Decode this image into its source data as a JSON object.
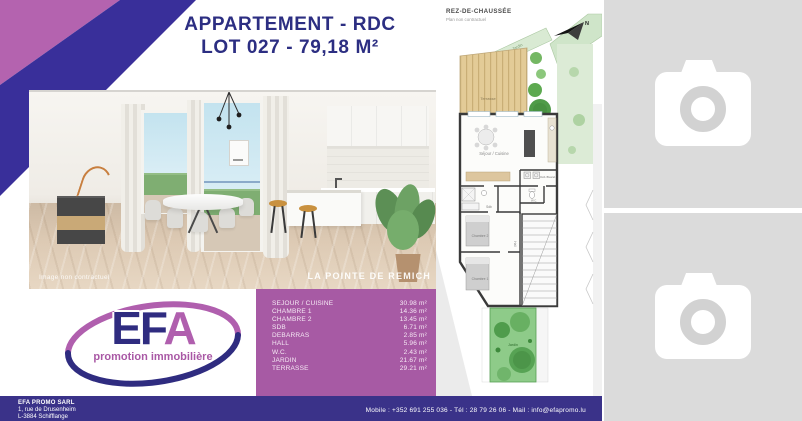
{
  "title": {
    "line1": "APPARTEMENT - RDC",
    "line2": "LOT 027 - 79,18 M²"
  },
  "render": {
    "disclaimer": "Image non contractuel",
    "project": "LA POINTE DE REMICH"
  },
  "areas": {
    "rows": [
      {
        "label": "SEJOUR / CUISINE",
        "value": "30.98 m²"
      },
      {
        "label": "CHAMBRE 1",
        "value": "14.36 m²"
      },
      {
        "label": "CHAMBRE 2",
        "value": "13.45 m²"
      },
      {
        "label": "SDB",
        "value": "6.71 m²"
      },
      {
        "label": "DEBARRAS",
        "value": "2.85 m²"
      },
      {
        "label": "HALL",
        "value": "5.96 m²"
      },
      {
        "label": "W.C.",
        "value": "2.43 m²"
      },
      {
        "label": "JARDIN",
        "value": "21.67 m²"
      },
      {
        "label": "TERRASSE",
        "value": "29.21 m²"
      }
    ]
  },
  "logo": {
    "ef": "EF",
    "a": "A",
    "tagline": "promotion immobilière"
  },
  "plan": {
    "header": "REZ-DE-CHAUSSÉE",
    "subheader": "Plan non contractuel",
    "north": "N",
    "labels": {
      "jardin_top": "Jardin",
      "terrasse": "Terrasse",
      "sejour": "Séjour / Cuisine",
      "deb": "Déb./Buand.",
      "wc": "W.C.",
      "sdb": "Sdb",
      "hall": "Hall",
      "chambre2": "Chambre 2",
      "chambre1": "Chambre 1",
      "jardin_bottom": "Jardin"
    }
  },
  "footer": {
    "company": "EFA PROMO SARL",
    "address1": "1, rue de Drusenheim",
    "address2": "L-3884 Schifflange",
    "contact": "Mobile : +352 691 255 036 - Tél : 28 79 26 06 - Mail : info@efapromo.lu"
  },
  "colors": {
    "accent_purple": "#a75aa4",
    "footer_navy": "#3a3289",
    "banner_pink": "#b463af",
    "banner_indigo": "#392f9a",
    "title_navy": "#2c2e82"
  }
}
